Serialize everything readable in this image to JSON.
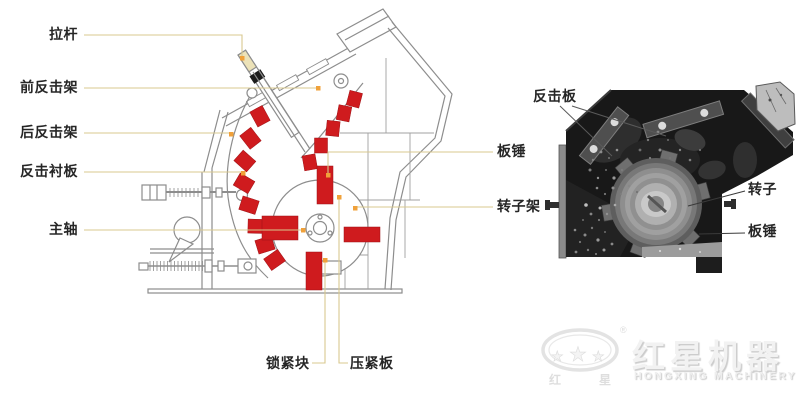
{
  "colors": {
    "red": "#cf1b1e",
    "leader_line": "#d8c88f",
    "leader_dot": "#f0a13a",
    "diagram_line": "#8d8d8d",
    "photo_background": "#181818"
  },
  "left_diagram": {
    "labels": {
      "lagan": "拉杆",
      "qian_fanji_jia": "前反击架",
      "hou_fanji_jia": "后反击架",
      "fanji_chenban": "反击衬板",
      "zhuzhou": "主轴",
      "banchui": "板锤",
      "zhuanzijia": "转子架",
      "suojinkuai": "锁紧块",
      "yajinban": "压紧板"
    }
  },
  "photo": {
    "labels": {
      "fanjiban": "反击板",
      "zhuanzi": "转子",
      "banchui": "板锤"
    }
  },
  "logo": {
    "brand_cn": "红星机器",
    "brand_en": "HONGXING MACHINERY",
    "registered_mark": "®",
    "seal_char_left": "红",
    "seal_char_right": "星",
    "star_glyph": "★"
  }
}
